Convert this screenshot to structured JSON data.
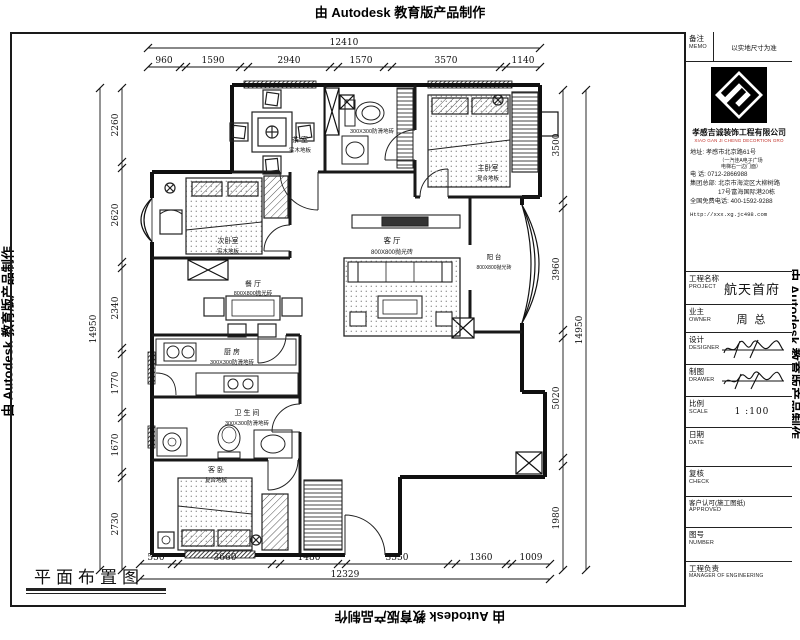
{
  "credits": {
    "autodesk": "由 Autodesk 教育版产品制作"
  },
  "sheet": {
    "drawing_title": "平面布置图"
  },
  "dimensions": {
    "top": {
      "overall": "12410",
      "segments": [
        "960",
        "1590",
        "2940",
        "1570",
        "3570",
        "1140"
      ]
    },
    "bottom": {
      "overall": "12329",
      "segments": [
        "550",
        "3660",
        "1480",
        "3550",
        "1360",
        "1009"
      ]
    },
    "left": {
      "overall": "14950",
      "segments": [
        "2260",
        "2620",
        "2340",
        "1770",
        "1670",
        "2730"
      ]
    },
    "right": {
      "overall": "14950",
      "segments": [
        "3500",
        "3960",
        "5020",
        "1980"
      ]
    }
  },
  "rooms": [
    {
      "name": "茶 室",
      "floor": "实木地板"
    },
    {
      "name": "",
      "floor": "300X300防滑地砖"
    },
    {
      "name": "主卧室",
      "floor": "复合地板"
    },
    {
      "name": "次卧室",
      "floor": "实木地板"
    },
    {
      "name": "餐 厅",
      "floor": "800X800抛光砖"
    },
    {
      "name": "客 厅",
      "floor": "800X800抛光砖"
    },
    {
      "name": "阳 台",
      "floor": "800X800抛光砖"
    },
    {
      "name": "厨 房",
      "floor": "300X300防滑地砖"
    },
    {
      "name": "卫 生 间",
      "floor": "300X300防滑地砖"
    },
    {
      "name": "客 卧",
      "floor": "复合地板"
    }
  ],
  "title_block": {
    "memo": {
      "label": "备注",
      "label_en": "MEMO",
      "value": "以实地尺寸为准"
    },
    "company": {
      "name": "孝感吉诚装饰工程有限公司",
      "name_en": "XIAO GAN JI CHENG DECORTION GRO"
    },
    "contact": [
      "地址:  孝感市北京路61号",
      "（一汽佳A电子广场",
      "电梯右一边门面）",
      "电    话:  0712-2866988",
      "集团总部: 北京市海淀区大柳树路",
      "17号富海国际港20栋",
      "全国免费电话: 400-1592-9288",
      "Http://xxx.xg.jc498.com"
    ],
    "rows": [
      {
        "label": "工程名称",
        "label_en": "PROJECT",
        "value": "航天首府"
      },
      {
        "label": "业主",
        "label_en": "OWNER",
        "value": "周 总"
      },
      {
        "label": "设计",
        "label_en": "DESIGNER",
        "value": ""
      },
      {
        "label": "制图",
        "label_en": "DRAWER",
        "value": ""
      },
      {
        "label": "比例",
        "label_en": "SCALE",
        "value": "1 :100"
      },
      {
        "label": "日期",
        "label_en": "DATE",
        "value": ""
      },
      {
        "label": "复核",
        "label_en": "CHECK",
        "value": ""
      },
      {
        "label": "客户认可(施工图纸)",
        "label_en": "APPROVED",
        "value": ""
      },
      {
        "label": "图号",
        "label_en": "NUMBER",
        "value": ""
      },
      {
        "label": "工程负责",
        "label_en": "MANAGER OF ENGINEERING",
        "value": ""
      }
    ]
  },
  "colors": {
    "accent_red": "#c03028",
    "line": "#1a1a1a"
  }
}
